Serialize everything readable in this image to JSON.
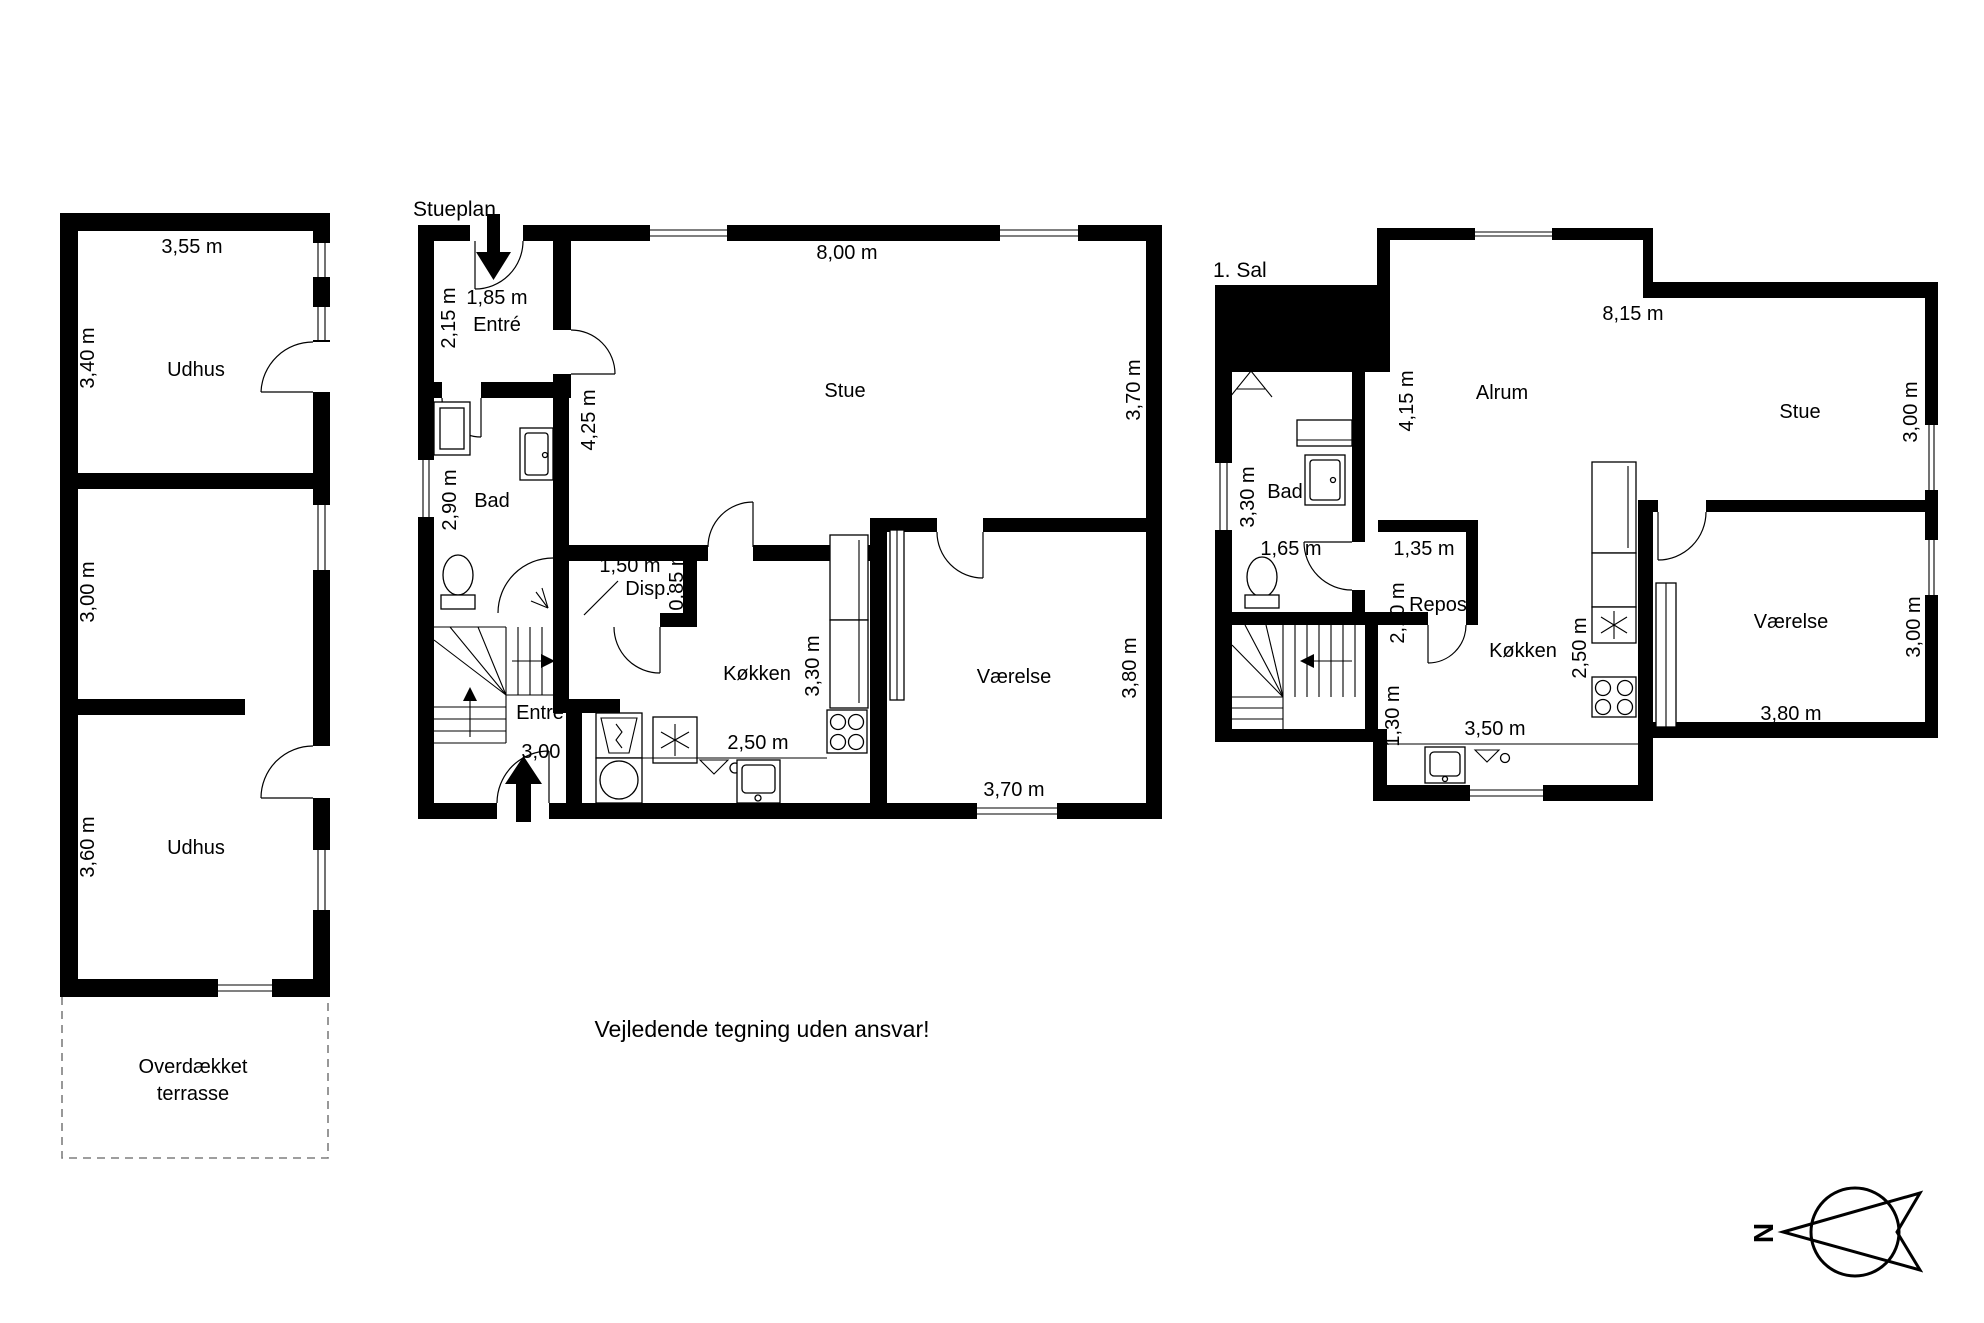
{
  "outbuilding": {
    "room1": {
      "name": "Udhus",
      "width": "3,55 m",
      "height": "3,40 m"
    },
    "room2": {
      "height": "3,00 m"
    },
    "room3": {
      "name": "Udhus",
      "height": "3,60 m"
    },
    "terrace": {
      "line1": "Overdækket",
      "line2": "terrasse"
    }
  },
  "ground_floor": {
    "title": "Stueplan",
    "entry_top": {
      "name": "Entré",
      "width": "1,85 m",
      "depth": "2,15 m"
    },
    "stue": {
      "name": "Stue",
      "width": "8,00 m",
      "depth": "3,70 m",
      "inner_height": "4,25 m"
    },
    "bad": {
      "name": "Bad",
      "depth": "2,90 m"
    },
    "disp": {
      "name": "Disp.",
      "width": "1,50 m",
      "depth": "0,85 m"
    },
    "entry": {
      "name": "Entré",
      "width": "3,00 m"
    },
    "kitchen": {
      "name": "Køkken",
      "depth": "3,30 m",
      "width": "2,50 m"
    },
    "bedroom": {
      "name": "Værelse",
      "width": "3,70 m",
      "depth": "3,80 m"
    }
  },
  "first_floor": {
    "title": "1. Sal",
    "alrum": {
      "name": "Alrum",
      "width": "8,15 m",
      "depth": "4,15 m"
    },
    "stue": {
      "name": "Stue",
      "depth": "3,00 m"
    },
    "bad": {
      "name": "Bad",
      "depth": "3,30 m",
      "width": "1,65 m"
    },
    "landing": {
      "name": "Repos",
      "width": "1,35 m",
      "depth": "2,10 m"
    },
    "kitchen": {
      "name": "Køkken",
      "depth": "2,50 m",
      "width": "3,50 m",
      "nook": "1,30 m"
    },
    "bedroom": {
      "name": "Værelse",
      "width": "3,80 m",
      "depth": "3,00 m"
    }
  },
  "compass": {
    "north": "N"
  },
  "footer": "Vejledende tegning uden ansvar!"
}
